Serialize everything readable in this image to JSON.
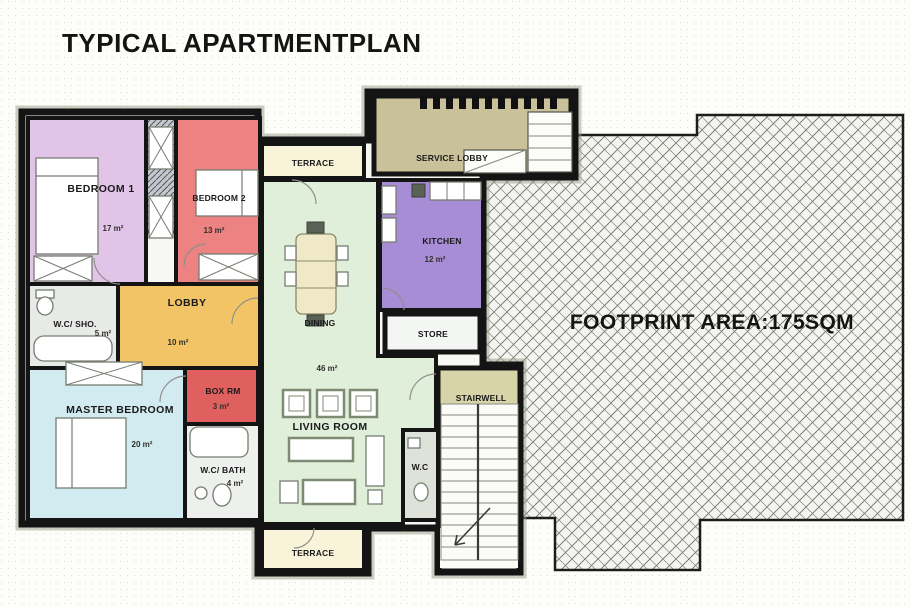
{
  "title": "TYPICAL APARTMENTPLAN",
  "footprint": {
    "label": "FOOTPRINT AREA:175SQM"
  },
  "rooms": {
    "bedroom1": {
      "name": "BEDROOM 1",
      "area": "17 m²",
      "color": "#e2c4e8"
    },
    "bedroom2": {
      "name": "BEDROOM 2",
      "area": "13 m²",
      "color": "#ec8282"
    },
    "terrace_top": {
      "name": "TERRACE",
      "color": "#f8f3d9"
    },
    "service_lobby": {
      "name": "SERVICE LOBBY",
      "color": "#c8c19a"
    },
    "kitchen": {
      "name": "KITCHEN",
      "area": "12 m²",
      "color": "#a78dd6"
    },
    "store": {
      "name": "STORE",
      "color": "#f3f6f2"
    },
    "dining": {
      "name": "DINING",
      "color": "#e0efda"
    },
    "living_room": {
      "name": "LIVING ROOM",
      "area": "46 m²"
    },
    "lobby": {
      "name": "LOBBY",
      "area": "10 m²",
      "color": "#f2c466"
    },
    "wc_shower": {
      "name": "W.C/ SHO.",
      "area": "5 m²",
      "color": "#e7eae6"
    },
    "box_room": {
      "name": "BOX RM",
      "area": "3 m²",
      "color": "#e05f5f"
    },
    "master_bedroom": {
      "name": "MASTER BEDROOM",
      "area": "20 m²",
      "color": "#d2ebf1"
    },
    "wc_bath": {
      "name": "W.C/ BATH",
      "area": "4 m²",
      "color": "#edf0ec"
    },
    "stairwell": {
      "name": "STAIRWELL",
      "color": "#d8d4aa"
    },
    "wc_small": {
      "name": "W.C",
      "color": "#dfe2d8"
    },
    "terrace_bottom": {
      "name": "TERRACE",
      "color": "#f8f3d9"
    }
  }
}
